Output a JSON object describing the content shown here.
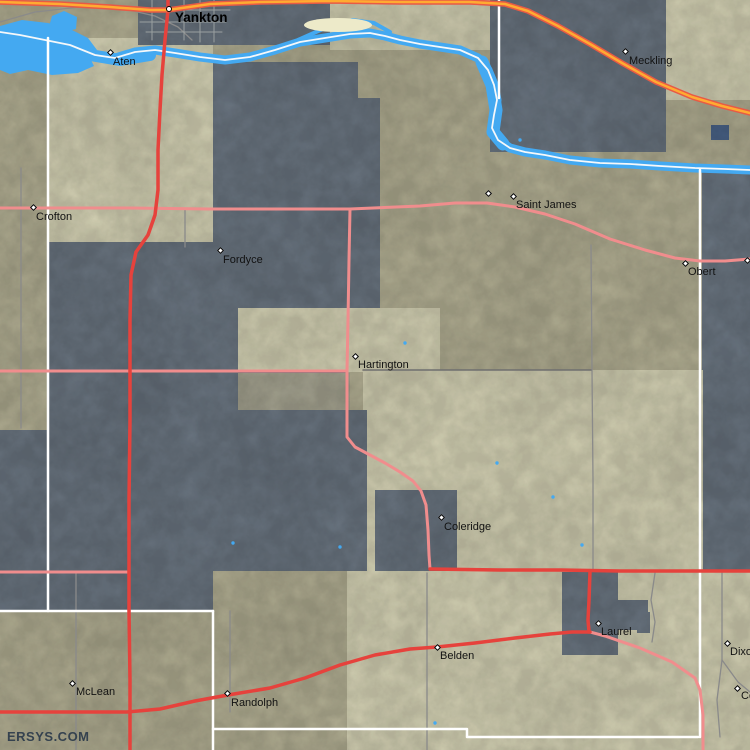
{
  "watermark": {
    "text": "ERSYS.COM",
    "x": 7,
    "y": 729
  },
  "colors": {
    "base": "#c7c3a4",
    "pale": "#edeac9",
    "gray": "#778390",
    "citypatch": "#b7b5a0",
    "water": "#44a9f1",
    "darkwater": "#54719b",
    "channel": "#f6f8fa",
    "pink": "#f08d8d",
    "red": "#e6423c",
    "orange": "#ffab32",
    "orange_casing": "#e85a45",
    "gray_road": "#8a8a8a",
    "darkgray_road": "#6f6f6f",
    "street": "#9aa0a0",
    "boundary": "#ffffff",
    "label": "#121212",
    "watermark_color": "#35424f"
  },
  "road_widths": {
    "pink": 3,
    "red": 3.5,
    "gray": 1.3,
    "darkgray": 1.5,
    "street": 1,
    "orange": 2.5,
    "orange_casing": 5.5
  },
  "regions": [
    {
      "id": "base-terrain",
      "color": "base",
      "rect": [
        0,
        0,
        750,
        750
      ]
    },
    {
      "id": "pale-crofton-aten",
      "color": "pale",
      "rect": [
        48,
        38,
        165,
        206
      ]
    },
    {
      "id": "pale-top-sd",
      "color": "pale",
      "rect": [
        330,
        0,
        169,
        50
      ]
    },
    {
      "id": "pale-top-ne-corner",
      "color": "pale",
      "rect": [
        664,
        0,
        86,
        100
      ]
    },
    {
      "id": "gray-yankton-strip",
      "color": "gray",
      "rect": [
        138,
        0,
        192,
        45
      ]
    },
    {
      "id": "gray-meckling",
      "color": "gray",
      "rect": [
        490,
        0,
        176,
        152
      ]
    },
    {
      "id": "gray-east-strip",
      "color": "gray",
      "rect": [
        702,
        170,
        48,
        400
      ]
    },
    {
      "id": "gray-west-large",
      "color": "gray",
      "rect": [
        48,
        242,
        165,
        369
      ]
    },
    {
      "id": "gray-left-strip",
      "color": "gray",
      "rect": [
        0,
        430,
        48,
        181
      ]
    },
    {
      "id": "gray-fordyce",
      "color": "gray",
      "pts": "213,62 358,62 358,98 380,98 380,310 238,310 238,372 213,372"
    },
    {
      "id": "pale-hartington",
      "color": "pale",
      "rect": [
        238,
        308,
        202,
        64
      ]
    },
    {
      "id": "pale-southeast",
      "color": "pale",
      "rect": [
        363,
        370,
        340,
        201
      ]
    },
    {
      "id": "gray-middle",
      "color": "gray",
      "pts": "213,372 347,372 347,410 367,410 367,571 213,571"
    },
    {
      "id": "city-hartington",
      "color": "citypatch",
      "rect": [
        238,
        373,
        112,
        37
      ]
    },
    {
      "id": "gray-coleridge",
      "color": "gray",
      "rect": [
        375,
        490,
        82,
        81
      ]
    },
    {
      "id": "pale-bottom",
      "color": "pale",
      "rect": [
        347,
        571,
        403,
        179
      ]
    },
    {
      "id": "gray-laurel",
      "color": "gray",
      "rect": [
        562,
        572,
        56,
        83
      ]
    },
    {
      "id": "gray-laurel-arm",
      "color": "gray",
      "rect": [
        617,
        600,
        31,
        30
      ]
    },
    {
      "id": "gray-laurel-arm2",
      "color": "gray",
      "rect": [
        637,
        612,
        13,
        21
      ]
    },
    {
      "id": "dark-pond",
      "color": "darkwater",
      "rect": [
        711,
        125,
        18,
        15
      ]
    }
  ],
  "water": {
    "lake_pts": "0,26 22,20 48,23 70,29 88,38 97,50 90,58 94,66 78,73 52,75 28,70 10,74 0,70",
    "arm_pts": "48,30 52,16 64,11 77,17 76,29 60,33",
    "river_channel": "0,32 20,35 45,40 70,45 95,55 115,58 135,52 155,50 175,53 200,57 225,60 250,57 275,50 300,42 325,38 350,34 370,33 385,36 400,40 420,44 440,47 460,50 478,58 488,70 494,85 497,100 494,115 492,128 498,140 510,148 525,152 545,155 570,160 600,163 630,164 660,166 695,168 725,169 750,170",
    "wide_bend": "482,62 492,85 496,110 493,132 503,144",
    "mouth": "90,55 120,60 150,55",
    "north_branch": "298,40 325,28 352,20 374,23 390,32",
    "island": {
      "cx": 338,
      "cy": 25,
      "rx": 34,
      "ry": 7
    },
    "ponds": [
      [
        405,
        343
      ],
      [
        497,
        463
      ],
      [
        553,
        497
      ],
      [
        582,
        545
      ],
      [
        233,
        543
      ],
      [
        340,
        547
      ],
      [
        435,
        723
      ],
      [
        520,
        140
      ]
    ]
  },
  "boundaries": [
    {
      "id": "knox-cedar-line",
      "pts": "48,38 48,611"
    },
    {
      "id": "south-line-west",
      "pts": "0,611 213,611"
    },
    {
      "id": "wayne-line",
      "pts": "213,611 213,750"
    },
    {
      "id": "south-line-east",
      "pts": "213,729 467,729 467,737 698,737"
    },
    {
      "id": "cedar-dixon-line",
      "pts": "700,170 700,737"
    },
    {
      "id": "sd-county-line",
      "pts": "499,0 499,98"
    }
  ],
  "roads": [
    {
      "id": "county-road-w",
      "kind": "gray",
      "pts": "21,168 21,300 21,428"
    },
    {
      "id": "crofton-spur",
      "kind": "gray",
      "pts": "185,210 185,247"
    },
    {
      "id": "randolph-north-road",
      "kind": "gray",
      "pts": "230,611 230,712"
    },
    {
      "id": "mclean-road",
      "kind": "gray",
      "pts": "76,572 76,750"
    },
    {
      "id": "obert-south-road",
      "kind": "gray",
      "pts": "591,245 592,370 593,480 593,570"
    },
    {
      "id": "township-road-370",
      "kind": "darkgray",
      "pts": "363,370 480,370 591,370"
    },
    {
      "id": "belden-road",
      "kind": "gray",
      "pts": "427,573 427,660 427,750"
    },
    {
      "id": "laurel-south-road",
      "kind": "gray",
      "pts": "655,573 651,600 655,622 652,642"
    },
    {
      "id": "concord-road",
      "kind": "gray",
      "pts": "722,573 722,660 738,682 750,692"
    },
    {
      "id": "concord-road-south",
      "kind": "gray",
      "pts": "722,660 717,700 720,737"
    },
    {
      "id": "lake-shore-road",
      "kind": "gray",
      "pts": "0,22 35,12 80,7 120,8 155,16 178,27 192,40"
    },
    {
      "id": "yankton-street-1",
      "kind": "street",
      "pts": "140,10 230,10"
    },
    {
      "id": "yankton-street-2",
      "kind": "street",
      "pts": "140,22 226,22"
    },
    {
      "id": "yankton-street-3",
      "kind": "street",
      "pts": "146,32 222,32"
    },
    {
      "id": "yankton-street-4",
      "kind": "street",
      "pts": "152,0 152,40"
    },
    {
      "id": "yankton-street-5",
      "kind": "street",
      "pts": "184,0 184,40"
    },
    {
      "id": "yankton-street-6",
      "kind": "street",
      "pts": "200,0 200,42"
    },
    {
      "id": "yankton-street-7",
      "kind": "street",
      "pts": "214,0 214,42"
    },
    {
      "id": "hwy-crofton-obert",
      "kind": "pink",
      "pts": "0,208 60,208 130,208 210,209 300,209 350,209 420,206 455,203 487,203 515,207 545,214 575,224 610,239 645,250 675,258 700,261 725,261 750,259"
    },
    {
      "id": "hwy-hartington-coleridge",
      "kind": "pink",
      "pts": "350,209 349,260 348,320 347,371 347,437 355,447 370,455 385,463 400,472 413,481 421,491 426,505 428,530 429,555 430,569"
    },
    {
      "id": "hwy-371-west",
      "kind": "pink",
      "pts": "0,371 100,371 200,371 280,371 347,371"
    },
    {
      "id": "hwy-572-west",
      "kind": "pink",
      "pts": "0,572 127,572"
    },
    {
      "id": "hwy-laurel-se",
      "kind": "pink",
      "pts": "590,632 605,636 640,648 672,662 695,678 700,690 703,715 703,750"
    },
    {
      "id": "hwy-81-yankton",
      "kind": "red",
      "pts": "168,0 168,10 165,40 162,75 160,110 158,150 158,190 155,215 148,235 136,252 131,275 130,320 130,420 129,500 129,610 130,680 130,712 130,750"
    },
    {
      "id": "hwy-20-randolph-laurel",
      "kind": "red",
      "pts": "0,712 127,712 160,709 195,701 228,695 270,688 305,678 340,665 375,655 410,649 437,647 475,643 515,638 550,634 572,632 590,632"
    },
    {
      "id": "hwy-laurel-north",
      "kind": "red",
      "pts": "590,571 589,600 588,620 589,632"
    },
    {
      "id": "hwy-coleridge-east",
      "kind": "red",
      "pts": "430,569 500,570 560,570 620,571 700,571 750,571"
    },
    {
      "id": "hwy-50-sd",
      "kind": "orange",
      "pts": "0,2 60,4 110,7 150,10 168,10 210,4 260,2 330,1 400,2 470,2 505,4 528,11 558,26 590,44 622,63 656,82 692,97 722,106 750,113"
    }
  ],
  "towns": [
    {
      "id": "yankton",
      "label": "Yankton",
      "x": 169,
      "y": 9,
      "lx": 175,
      "ly": 11,
      "marker": "circle",
      "bold": true
    },
    {
      "id": "aten",
      "label": "Aten",
      "x": 110,
      "y": 52,
      "lx": 113,
      "ly": 57
    },
    {
      "id": "meckling",
      "label": "Meckling",
      "x": 625,
      "y": 51,
      "lx": 629,
      "ly": 56
    },
    {
      "id": "crofton",
      "label": "Crofton",
      "x": 33,
      "y": 207,
      "lx": 36,
      "ly": 212
    },
    {
      "id": "fordyce",
      "label": "Fordyce",
      "x": 220,
      "y": 250,
      "lx": 223,
      "ly": 255
    },
    {
      "id": "saint-james",
      "label": "Saint James",
      "x": 513,
      "y": 196,
      "lx": 516,
      "ly": 200
    },
    {
      "id": "saint-james-w",
      "label": "",
      "x": 488,
      "y": 193
    },
    {
      "id": "obert",
      "label": "Obert",
      "x": 685,
      "y": 263,
      "lx": 688,
      "ly": 267
    },
    {
      "id": "obert-east",
      "label": "",
      "x": 747,
      "y": 260
    },
    {
      "id": "hartington",
      "label": "Hartington",
      "x": 355,
      "y": 356,
      "lx": 358,
      "ly": 360
    },
    {
      "id": "coleridge",
      "label": "Coleridge",
      "x": 441,
      "y": 517,
      "lx": 444,
      "ly": 522
    },
    {
      "id": "laurel",
      "label": "Laurel",
      "x": 598,
      "y": 623,
      "lx": 601,
      "ly": 627
    },
    {
      "id": "belden",
      "label": "Belden",
      "x": 437,
      "y": 647,
      "lx": 440,
      "ly": 651
    },
    {
      "id": "dixon",
      "label": "Dixon",
      "x": 727,
      "y": 643,
      "lx": 730,
      "ly": 647
    },
    {
      "id": "concord",
      "label": "Concord",
      "x": 737,
      "y": 688,
      "lx": 741,
      "ly": 691
    },
    {
      "id": "mclean",
      "label": "McLean",
      "x": 72,
      "y": 683,
      "lx": 76,
      "ly": 687
    },
    {
      "id": "randolph",
      "label": "Randolph",
      "x": 227,
      "y": 693,
      "lx": 231,
      "ly": 698
    }
  ]
}
